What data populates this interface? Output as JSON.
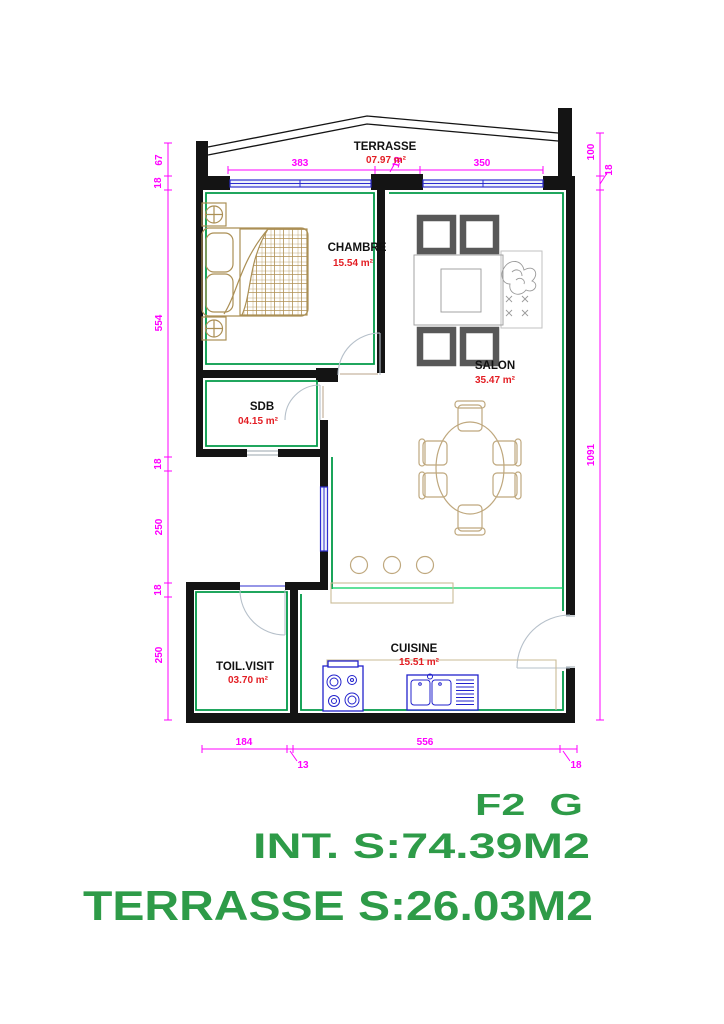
{
  "drawing": {
    "rooms": [
      {
        "id": "terrasse",
        "name": "TERRASSE",
        "area": "07.97 m²"
      },
      {
        "id": "chambre",
        "name": "CHAMBRE",
        "area": "15.54 m²"
      },
      {
        "id": "salon",
        "name": "SALON",
        "area": "35.47 m²"
      },
      {
        "id": "sdb",
        "name": "SDB",
        "area": "04.15 m²"
      },
      {
        "id": "toilette",
        "name": "TOIL.VISIT",
        "area": "03.70 m²"
      },
      {
        "id": "cuisine",
        "name": "CUISINE",
        "area": "15.51 m²"
      }
    ],
    "dimensions": {
      "top": [
        "383",
        "19",
        "350"
      ],
      "left": [
        "67",
        "18",
        "554",
        "18",
        "250",
        "18",
        "250"
      ],
      "right": [
        "100",
        "18",
        "1091"
      ],
      "bottom": [
        "184",
        "13",
        "556",
        "18"
      ]
    },
    "title_block": {
      "unit": "F2  G",
      "interior_area": "INT. S:74.39M2",
      "terrace_area": "TERRASSE S:26.03M2"
    },
    "colors": {
      "walls": "#141414",
      "wall_trace": "#009a48",
      "floor_line": "#00cf5e",
      "windows": "#2d2dcf",
      "dimensions": "#ff00ff",
      "room_name": "#111111",
      "room_area": "#e31e24",
      "doors": "#b6c0ca",
      "bed": "#ab8f55",
      "dining": "#bfa87e",
      "armchair": "#585858",
      "counter": "#c9bb96",
      "fixtures": "#2222cc",
      "title_text": "#2e9b48"
    }
  }
}
